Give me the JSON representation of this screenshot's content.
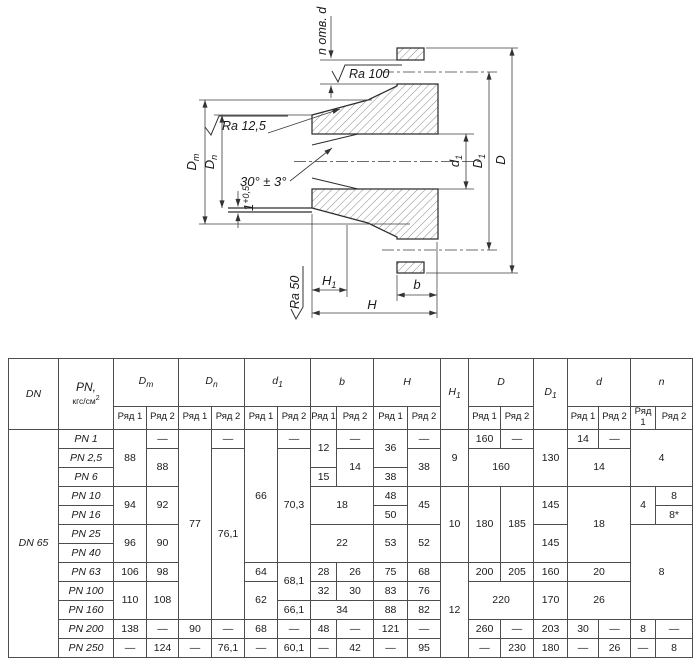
{
  "drawing": {
    "holes_note": "n отв. d",
    "ra_100": "Ra 100",
    "ra_12_5": "Ra 12,5",
    "ra_50": "Ra 50",
    "angle": "30° ± 3°",
    "lip": {
      "b": "1",
      "sup": "+0,5"
    },
    "dim": {
      "Dm": {
        "b": "D",
        "s": "m"
      },
      "Dn": {
        "b": "D",
        "s": "n"
      },
      "d1": {
        "b": "d",
        "s": "1"
      },
      "D1": {
        "b": "D",
        "s": "1"
      },
      "D": {
        "b": "D",
        "s": ""
      },
      "H1": {
        "b": "H",
        "s": "1"
      },
      "H": {
        "b": "H",
        "s": ""
      },
      "b": {
        "b": "b",
        "s": ""
      }
    }
  },
  "table": {
    "header": {
      "dn": "DN",
      "pn1": "PN,",
      "pn2": "кгс/см",
      "pn_sup": "2",
      "ryad1": "Ряд 1",
      "ryad2": "Ряд 2",
      "cols": {
        "dm": {
          "b": "D",
          "s": "m"
        },
        "dn": {
          "b": "D",
          "s": "n"
        },
        "d1": {
          "b": "d",
          "s": "1"
        },
        "b": {
          "b": "b",
          "s": ""
        },
        "H": {
          "b": "H",
          "s": ""
        },
        "H1": {
          "b": "H",
          "s": "1"
        },
        "D": {
          "b": "D",
          "s": ""
        },
        "D1": {
          "b": "D",
          "s": "1"
        },
        "d": {
          "b": "d",
          "s": ""
        },
        "n": {
          "b": "n",
          "s": ""
        }
      }
    },
    "dn_value": "DN 65",
    "rows": [
      {
        "pn": "PN 1",
        "dm1": "88",
        "dm2": "—",
        "dn1": "77",
        "dn2": "—",
        "d11": "66",
        "d12": "—",
        "b1": "12",
        "b2": "—",
        "H1": "36",
        "H2": "—",
        "h1": "9",
        "D1": "160",
        "D2": "—",
        "Dd1": "130",
        "d1": "14",
        "d2": "—",
        "n": "4"
      },
      {
        "pn": "PN 2,5",
        "dm2": "88",
        "dn2": "76,1",
        "d12": "70,3",
        "b2": "14",
        "H2": "38",
        "D": "160",
        "d": "14"
      },
      {
        "pn": "PN 6",
        "b1": "15",
        "H1": "38"
      },
      {
        "pn": "PN 10",
        "dm1": "94",
        "dm2": "92",
        "b": "18",
        "H1": "48",
        "H2": "45",
        "h1": "10",
        "D1": "180",
        "D2": "185",
        "Dd1": "145",
        "d": "18",
        "n1": "4",
        "n2": "8"
      },
      {
        "pn": "PN 16",
        "H1": "50",
        "n2": "8*"
      },
      {
        "pn": "PN 25",
        "dm1": "96",
        "dm2": "90",
        "b": "22",
        "H1": "53",
        "H2": "52",
        "Dd1": "145",
        "n": "8"
      },
      {
        "pn": "PN 40"
      },
      {
        "pn": "PN 63",
        "dm1": "106",
        "dm2": "98",
        "d11": "64",
        "d12": "68,1",
        "b1": "28",
        "b2": "26",
        "H1": "75",
        "H2": "68",
        "h1": "12",
        "D1": "200",
        "D2": "205",
        "Dd1": "160",
        "d": "20"
      },
      {
        "pn": "PN 100",
        "dm1": "110",
        "dm2": "108",
        "d11": "62",
        "b1": "32",
        "b2": "30",
        "H1": "83",
        "H2": "76",
        "D": "220",
        "Dd1": "170",
        "d": "26"
      },
      {
        "pn": "PN 160",
        "d12": "66,1",
        "b": "34",
        "H1": "88",
        "H2": "82"
      },
      {
        "pn": "PN 200",
        "dm1": "138",
        "dm2": "—",
        "dn1": "90",
        "dn2": "—",
        "d11": "68",
        "d12": "—",
        "b1": "48",
        "b2": "—",
        "H1": "121",
        "H2": "—",
        "D1": "260",
        "D2": "—",
        "Dd1": "203",
        "d1": "30",
        "d2": "—",
        "n1": "8",
        "n2": "—"
      },
      {
        "pn": "PN 250",
        "dm1": "—",
        "dm2": "124",
        "dn1": "—",
        "dn2": "76,1",
        "d11": "—",
        "d12": "60,1",
        "b1": "—",
        "b2": "42",
        "H1": "—",
        "H2": "95",
        "D1": "—",
        "D2": "230",
        "Dd1": "180",
        "d1": "—",
        "d2": "26",
        "n1": "—",
        "n2": "8"
      }
    ]
  }
}
